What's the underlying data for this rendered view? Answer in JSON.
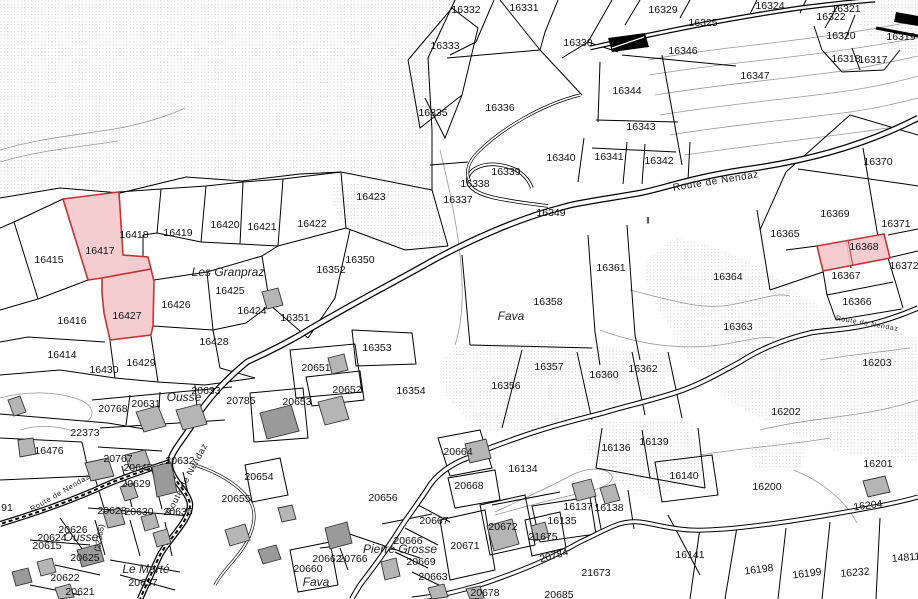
{
  "map": {
    "type": "cadastral-parcel-map",
    "colors": {
      "highlight_fill": "#f4c6ca",
      "highlight_stroke": "#c03636",
      "building_fill": "#b5b5b5",
      "stipple_dot": "#bdbdbd",
      "boundary": "#000000"
    },
    "highlighted_parcels": [
      "16417",
      "16427",
      "16368"
    ],
    "road_labels": [
      {
        "t": "Route de Nendaz",
        "x": 716,
        "y": 182,
        "r": -9,
        "s": 10
      },
      {
        "t": "Route de Nendaz",
        "x": 187,
        "y": 479,
        "r": -62,
        "s": 9
      },
      {
        "t": "Route de Nendaz",
        "x": 60,
        "y": 493,
        "r": -30,
        "s": 7.5
      },
      {
        "t": "Route de Nendaz",
        "x": 867,
        "y": 324,
        "r": 10,
        "s": 7
      }
    ],
    "localities": [
      {
        "t": "Les Granpraz",
        "x": 228,
        "y": 272
      },
      {
        "t": "Fava",
        "x": 511,
        "y": 316
      },
      {
        "t": "Ousse",
        "x": 184,
        "y": 397
      },
      {
        "t": "Ousse",
        "x": 81,
        "y": 537
      },
      {
        "t": "Le Marté",
        "x": 146,
        "y": 569
      },
      {
        "t": "Fava",
        "x": 316,
        "y": 582
      },
      {
        "t": "Pierre Grosse",
        "x": 400,
        "y": 549
      }
    ],
    "symbols": [
      {
        "t": "‖",
        "x": 648,
        "y": 221
      }
    ],
    "parcels": [
      {
        "n": "16332",
        "x": 466,
        "y": 10
      },
      {
        "n": "16331",
        "x": 524,
        "y": 8
      },
      {
        "n": "16329",
        "x": 663,
        "y": 10
      },
      {
        "n": "16324",
        "x": 770,
        "y": 6
      },
      {
        "n": "16325",
        "x": 703,
        "y": 23
      },
      {
        "n": "16321",
        "x": 846,
        "y": 9
      },
      {
        "n": "16322",
        "x": 831,
        "y": 17
      },
      {
        "n": "16320",
        "x": 841,
        "y": 36
      },
      {
        "n": "16319",
        "x": 901,
        "y": 37
      },
      {
        "n": "16318",
        "x": 846,
        "y": 59
      },
      {
        "n": "16317",
        "x": 873,
        "y": 60
      },
      {
        "n": "16333",
        "x": 445,
        "y": 46
      },
      {
        "n": "16330",
        "x": 578,
        "y": 43
      },
      {
        "n": "16335",
        "x": 433,
        "y": 113
      },
      {
        "n": "16336",
        "x": 500,
        "y": 108
      },
      {
        "n": "16346",
        "x": 683,
        "y": 51
      },
      {
        "n": "16347",
        "x": 755,
        "y": 76
      },
      {
        "n": "16344",
        "x": 627,
        "y": 91
      },
      {
        "n": "16343",
        "x": 641,
        "y": 127
      },
      {
        "n": "16340",
        "x": 561,
        "y": 158
      },
      {
        "n": "16341",
        "x": 609,
        "y": 157
      },
      {
        "n": "16342",
        "x": 659,
        "y": 161
      },
      {
        "n": "16339",
        "x": 506,
        "y": 172
      },
      {
        "n": "16338",
        "x": 475,
        "y": 184
      },
      {
        "n": "16337",
        "x": 458,
        "y": 200
      },
      {
        "n": "16349",
        "x": 551,
        "y": 213
      },
      {
        "n": "16350",
        "x": 360,
        "y": 260
      },
      {
        "n": "16352",
        "x": 331,
        "y": 270
      },
      {
        "n": "16351",
        "x": 295,
        "y": 318
      },
      {
        "n": "16353",
        "x": 377,
        "y": 348
      },
      {
        "n": "16354",
        "x": 411,
        "y": 391
      },
      {
        "n": "16356",
        "x": 506,
        "y": 386
      },
      {
        "n": "16357",
        "x": 549,
        "y": 367
      },
      {
        "n": "16358",
        "x": 548,
        "y": 302
      },
      {
        "n": "16360",
        "x": 604,
        "y": 375
      },
      {
        "n": "16361",
        "x": 611,
        "y": 268
      },
      {
        "n": "16362",
        "x": 643,
        "y": 369
      },
      {
        "n": "16363",
        "x": 738,
        "y": 327
      },
      {
        "n": "16364",
        "x": 728,
        "y": 277
      },
      {
        "n": "16365",
        "x": 785,
        "y": 234
      },
      {
        "n": "16366",
        "x": 857,
        "y": 302
      },
      {
        "n": "16367",
        "x": 846,
        "y": 276
      },
      {
        "n": "16368",
        "x": 864,
        "y": 247,
        "hl": true
      },
      {
        "n": "16369",
        "x": 835,
        "y": 214
      },
      {
        "n": "16370",
        "x": 878,
        "y": 162
      },
      {
        "n": "16371",
        "x": 896,
        "y": 224
      },
      {
        "n": "16372",
        "x": 904,
        "y": 266
      },
      {
        "n": "16423",
        "x": 371,
        "y": 197
      },
      {
        "n": "16422",
        "x": 312,
        "y": 224
      },
      {
        "n": "16421",
        "x": 262,
        "y": 227
      },
      {
        "n": "16420",
        "x": 225,
        "y": 225
      },
      {
        "n": "16419",
        "x": 178,
        "y": 233
      },
      {
        "n": "16418",
        "x": 134,
        "y": 235
      },
      {
        "n": "16417",
        "x": 100,
        "y": 251,
        "hl": true
      },
      {
        "n": "16415",
        "x": 49,
        "y": 260
      },
      {
        "n": "16416",
        "x": 72,
        "y": 321
      },
      {
        "n": "16427",
        "x": 127,
        "y": 316,
        "hl": true
      },
      {
        "n": "16426",
        "x": 176,
        "y": 305
      },
      {
        "n": "16425",
        "x": 230,
        "y": 291
      },
      {
        "n": "16424",
        "x": 252,
        "y": 311
      },
      {
        "n": "16414",
        "x": 62,
        "y": 355
      },
      {
        "n": "16428",
        "x": 214,
        "y": 342
      },
      {
        "n": "16429",
        "x": 141,
        "y": 363
      },
      {
        "n": "16430",
        "x": 104,
        "y": 370
      },
      {
        "n": "20651",
        "x": 316,
        "y": 368
      },
      {
        "n": "20652",
        "x": 347,
        "y": 390
      },
      {
        "n": "20653",
        "x": 297,
        "y": 402
      },
      {
        "n": "20785",
        "x": 241,
        "y": 401
      },
      {
        "n": "20633",
        "x": 206,
        "y": 391
      },
      {
        "n": "20768",
        "x": 113,
        "y": 409
      },
      {
        "n": "20631",
        "x": 146,
        "y": 404
      },
      {
        "n": "22373",
        "x": 85,
        "y": 433
      },
      {
        "n": "16476",
        "x": 49,
        "y": 451
      },
      {
        "n": "20767",
        "x": 118,
        "y": 459
      },
      {
        "n": "20645",
        "x": 138,
        "y": 468
      },
      {
        "n": "20632",
        "x": 180,
        "y": 461
      },
      {
        "n": "20629",
        "x": 136,
        "y": 484
      },
      {
        "n": "20628",
        "x": 112,
        "y": 511
      },
      {
        "n": "20630",
        "x": 139,
        "y": 512
      },
      {
        "n": "20635",
        "x": 178,
        "y": 512
      },
      {
        "n": "20626",
        "x": 73,
        "y": 530
      },
      {
        "n": "20624",
        "x": 52,
        "y": 538
      },
      {
        "n": "20615",
        "x": 47,
        "y": 546
      },
      {
        "n": "(22365)",
        "x": 100,
        "y": 538,
        "r": -80,
        "s": 8
      },
      {
        "n": "20625",
        "x": 85,
        "y": 558
      },
      {
        "n": "20622",
        "x": 65,
        "y": 578
      },
      {
        "n": "20621",
        "x": 80,
        "y": 592
      },
      {
        "n": "20637",
        "x": 143,
        "y": 583
      },
      {
        "n": "91",
        "x": 7,
        "y": 508
      },
      {
        "n": "20655",
        "x": 236,
        "y": 499
      },
      {
        "n": "20654",
        "x": 259,
        "y": 477
      },
      {
        "n": "20656",
        "x": 383,
        "y": 498
      },
      {
        "n": "20660",
        "x": 308,
        "y": 569
      },
      {
        "n": "20662",
        "x": 327,
        "y": 559
      },
      {
        "n": "20766",
        "x": 353,
        "y": 559
      },
      {
        "n": "20666",
        "x": 408,
        "y": 541
      },
      {
        "n": "20667",
        "x": 434,
        "y": 521
      },
      {
        "n": "20669",
        "x": 421,
        "y": 562
      },
      {
        "n": "20663",
        "x": 433,
        "y": 577
      },
      {
        "n": "20671",
        "x": 465,
        "y": 546
      },
      {
        "n": "20672",
        "x": 503,
        "y": 527
      },
      {
        "n": "21675",
        "x": 543,
        "y": 537
      },
      {
        "n": "16135",
        "x": 562,
        "y": 521
      },
      {
        "n": "16134",
        "x": 523,
        "y": 469
      },
      {
        "n": "16137",
        "x": 578,
        "y": 507
      },
      {
        "n": "16138",
        "x": 609,
        "y": 508
      },
      {
        "n": "16136",
        "x": 616,
        "y": 448
      },
      {
        "n": "16139",
        "x": 654,
        "y": 442
      },
      {
        "n": "16140",
        "x": 684,
        "y": 476
      },
      {
        "n": "20664",
        "x": 458,
        "y": 452
      },
      {
        "n": "20668",
        "x": 469,
        "y": 486
      },
      {
        "n": "20784",
        "x": 554,
        "y": 556,
        "r": -15
      },
      {
        "n": "21673",
        "x": 596,
        "y": 573
      },
      {
        "n": "20678",
        "x": 485,
        "y": 593
      },
      {
        "n": "20685",
        "x": 559,
        "y": 595
      },
      {
        "n": "16141",
        "x": 690,
        "y": 555
      },
      {
        "n": "16198",
        "x": 759,
        "y": 570,
        "r": -7
      },
      {
        "n": "16199",
        "x": 807,
        "y": 574,
        "r": -7
      },
      {
        "n": "16232",
        "x": 855,
        "y": 573,
        "r": -5
      },
      {
        "n": "14811",
        "x": 906,
        "y": 558,
        "r": -5
      },
      {
        "n": "16200",
        "x": 767,
        "y": 487
      },
      {
        "n": "16201",
        "x": 878,
        "y": 464
      },
      {
        "n": "16204",
        "x": 868,
        "y": 506,
        "r": -7
      },
      {
        "n": "16202",
        "x": 786,
        "y": 412
      },
      {
        "n": "16203",
        "x": 877,
        "y": 363
      }
    ]
  }
}
